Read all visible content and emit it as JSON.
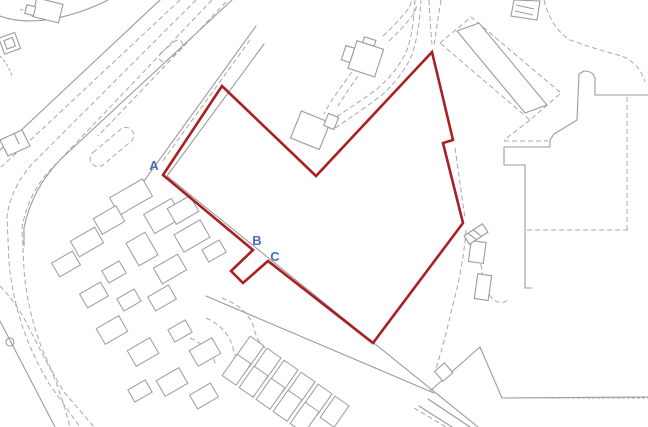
{
  "map": {
    "title": "site-location-plan",
    "background_color": "#ffffff",
    "base_line_color": "#9b9b9b",
    "dashed_line_color": "#a8a8a8",
    "boundary": {
      "color": "#a91f23",
      "stroke_width": 2.6,
      "points": [
        [
          163,
          175
        ],
        [
          222,
          86
        ],
        [
          316,
          176
        ],
        [
          432,
          52
        ],
        [
          453,
          140
        ],
        [
          443,
          143
        ],
        [
          463,
          223
        ],
        [
          373,
          343
        ],
        [
          268,
          261
        ],
        [
          243,
          283
        ],
        [
          231,
          271
        ],
        [
          253,
          250
        ]
      ]
    },
    "markers": {
      "color": "#4a6bc5",
      "items": [
        {
          "label": "A",
          "x": 154,
          "y": 170
        },
        {
          "label": "B",
          "x": 257,
          "y": 245
        },
        {
          "label": "C",
          "x": 275,
          "y": 261
        }
      ]
    }
  }
}
